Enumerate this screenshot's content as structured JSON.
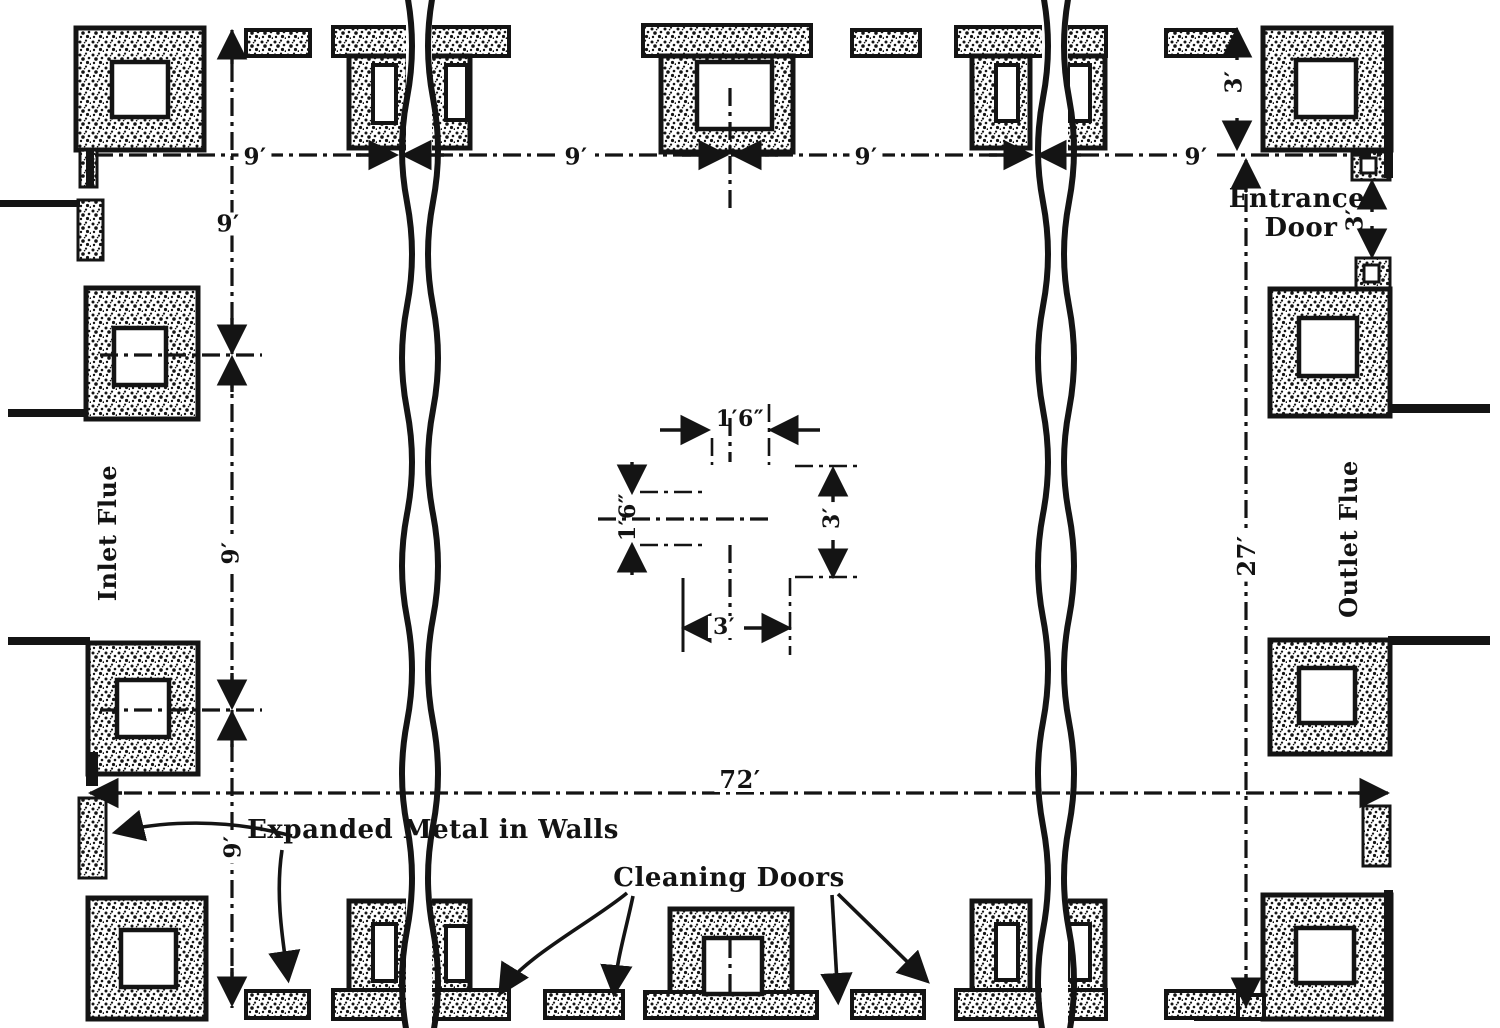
{
  "figure": {
    "type": "engineering-floor-plan",
    "subject": "brick flue dust chamber plan with hollow piers, expansion break lines and flue openings",
    "colors": {
      "ink": "#141414",
      "paper": "#ffffff"
    },
    "labels": {
      "inlet_flue": "Inlet Flue",
      "outlet_flue": "Outlet Flue",
      "entrance_door_line1": "Entrance",
      "entrance_door_line2": "Door",
      "expanded_metal": "Expanded Metal in Walls",
      "cleaning_doors": "Cleaning Doors"
    },
    "dimensions": {
      "bay_top": [
        "9′",
        "9′",
        "9′",
        "9′"
      ],
      "bay_left": [
        "9′",
        "9′",
        "9′"
      ],
      "overall_length": "72′",
      "overall_width": "27′",
      "wall_row_depth": "3′",
      "entrance_door": "3′",
      "pier_width": "3′",
      "pier_height": "3′",
      "core_width": "1′6″",
      "core_height": "1′6″"
    }
  }
}
